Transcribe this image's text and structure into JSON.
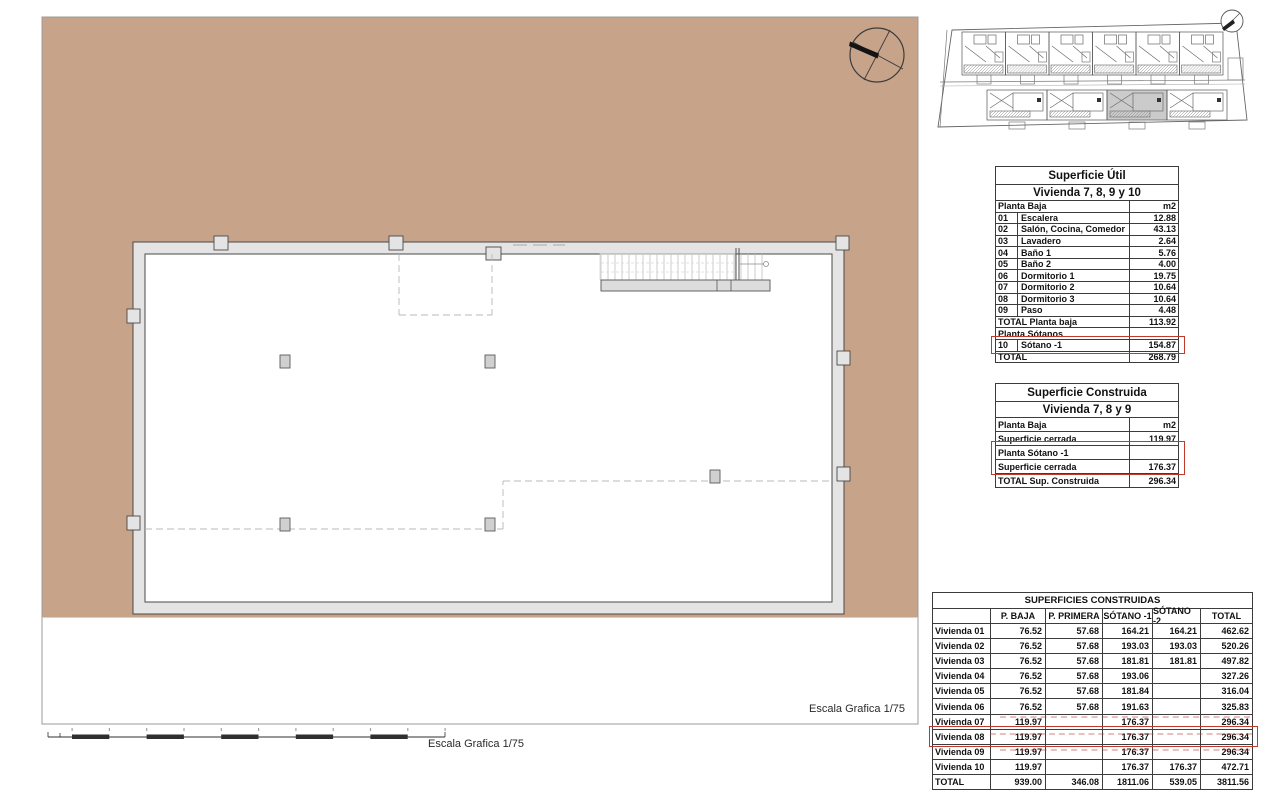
{
  "colors": {
    "plot_tan": "#c7a38a",
    "wall_fill": "#e4e4e4",
    "wall_stroke": "#4a4a4a",
    "highlight_red": "#c0392b"
  },
  "labels": {
    "escala_right": "Escala Grafica 1/75",
    "escala_bottom": "Escala Grafica 1/75"
  },
  "tables": {
    "util": {
      "title": "Superficie Útil",
      "subtitle": "Vivienda 7, 8, 9 y 10",
      "header": {
        "label": "Planta Baja",
        "unit": "m2"
      },
      "rows": [
        {
          "num": "01",
          "label": "Escalera",
          "value": "12.88"
        },
        {
          "num": "02",
          "label": "Salón, Cocina, Comedor",
          "value": "43.13"
        },
        {
          "num": "03",
          "label": "Lavadero",
          "value": "2.64"
        },
        {
          "num": "04",
          "label": "Baño 1",
          "value": "5.76"
        },
        {
          "num": "05",
          "label": "Baño 2",
          "value": "4.00"
        },
        {
          "num": "06",
          "label": "Dormitorio 1",
          "value": "19.75"
        },
        {
          "num": "07",
          "label": "Dormitorio 2",
          "value": "10.64"
        },
        {
          "num": "08",
          "label": "Dormitorio 3",
          "value": "10.64"
        },
        {
          "num": "09",
          "label": "Paso",
          "value": "4.48"
        }
      ],
      "total_planta_baja": {
        "label": "TOTAL Planta baja",
        "value": "113.92"
      },
      "planta_sotanos": {
        "label": "Planta Sótanos",
        "value": ""
      },
      "sotano_row": {
        "num": "10",
        "label": "Sótano -1",
        "value": "154.87"
      },
      "total": {
        "label": "TOTAL",
        "value": "268.79"
      }
    },
    "construida": {
      "title": "Superficie Construida",
      "subtitle": "Vivienda 7, 8 y 9",
      "header": {
        "label": "Planta Baja",
        "unit": "m2"
      },
      "rows": [
        {
          "label": "Superficie cerrada",
          "value": "119.97"
        },
        {
          "label": "Planta Sótano -1",
          "value": ""
        },
        {
          "label": "Superficie cerrada",
          "value": "176.37"
        },
        {
          "label": "TOTAL Sup. Construida",
          "value": "296.34"
        }
      ]
    },
    "resumen": {
      "title": "SUPERFICIES CONSTRUIDAS",
      "headers": [
        "",
        "P. BAJA",
        "P. PRIMERA",
        "SÓTANO -1",
        "SÓTANO -2",
        "TOTAL"
      ],
      "rows": [
        {
          "name": "Vivienda 01",
          "pbaja": "76.52",
          "pprimera": "57.68",
          "sotano1": "164.21",
          "sotano2": "164.21",
          "total": "462.62"
        },
        {
          "name": "Vivienda 02",
          "pbaja": "76.52",
          "pprimera": "57.68",
          "sotano1": "193.03",
          "sotano2": "193.03",
          "total": "520.26"
        },
        {
          "name": "Vivienda 03",
          "pbaja": "76.52",
          "pprimera": "57.68",
          "sotano1": "181.81",
          "sotano2": "181.81",
          "total": "497.82"
        },
        {
          "name": "Vivienda 04",
          "pbaja": "76.52",
          "pprimera": "57.68",
          "sotano1": "193.06",
          "sotano2": "",
          "total": "327.26"
        },
        {
          "name": "Vivienda 05",
          "pbaja": "76.52",
          "pprimera": "57.68",
          "sotano1": "181.84",
          "sotano2": "",
          "total": "316.04"
        },
        {
          "name": "Vivienda 06",
          "pbaja": "76.52",
          "pprimera": "57.68",
          "sotano1": "191.63",
          "sotano2": "",
          "total": "325.83"
        },
        {
          "name": "Vivienda 07",
          "pbaja": "119.97",
          "pprimera": "",
          "sotano1": "176.37",
          "sotano2": "",
          "total": "296.34"
        },
        {
          "name": "Vivienda 08",
          "pbaja": "119.97",
          "pprimera": "",
          "sotano1": "176.37",
          "sotano2": "",
          "total": "296.34"
        },
        {
          "name": "Vivienda 09",
          "pbaja": "119.97",
          "pprimera": "",
          "sotano1": "176.37",
          "sotano2": "",
          "total": "296.34"
        },
        {
          "name": "Vivienda 10",
          "pbaja": "119.97",
          "pprimera": "",
          "sotano1": "176.37",
          "sotano2": "176.37",
          "total": "472.71"
        }
      ],
      "total_row": {
        "name": "TOTAL",
        "pbaja": "939.00",
        "pprimera": "346.08",
        "sotano1": "1811.06",
        "sotano2": "539.05",
        "total": "3811.56"
      }
    }
  }
}
